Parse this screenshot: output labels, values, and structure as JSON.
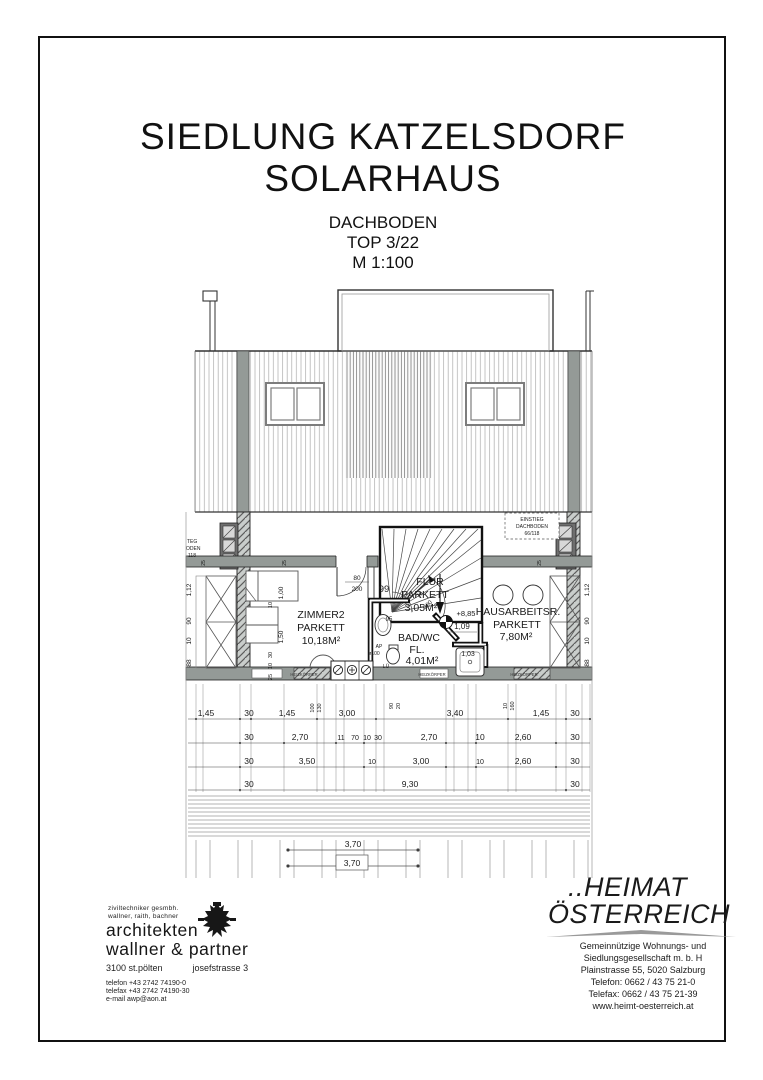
{
  "page": {
    "title1": "SIEDLUNG KATZELSDORF",
    "title2": "SOLARHAUS",
    "sub1": "DACHBODEN",
    "sub2": "TOP 3/22",
    "sub3": "M 1:100"
  },
  "plan": {
    "rooms": {
      "zimmer2": {
        "l1": "ZIMMER2",
        "l2": "PARKETT",
        "l3": "10,18M²"
      },
      "flur": {
        "l1": "FLUR",
        "l2": "PARKETT",
        "l3": "3,05M²"
      },
      "bad": {
        "l1": "BAD/WC",
        "l2": "FL.",
        "l3": "4,01M²"
      },
      "hausarbeit": {
        "l1": "HAUSARBEITSR.",
        "l2": "PARKETT",
        "l3": "7,80M²"
      }
    },
    "labels": {
      "left_l1": "TEG",
      "left_l2": "ODEN",
      "left_l3": "118",
      "right_l1": "EINSTIEG",
      "right_l2": "DACHBODEN",
      "right_l3": "66/118",
      "level": "+8,85",
      "heizkoerper": "HEIZKÖRPER",
      "ap": "AP",
      "d100": "ø100",
      "lue": "LÜ"
    },
    "dims": {
      "r1": [
        "1,45",
        "30",
        "1,45",
        "3,00",
        "3,40",
        "1,45",
        "30"
      ],
      "r1v": [
        "100",
        "130",
        "90",
        "20",
        "10",
        "160"
      ],
      "r2": [
        "30",
        "2,70",
        "11",
        "70",
        "10",
        "30",
        "2,70",
        "10",
        "2,60",
        "30"
      ],
      "r3": [
        "30",
        "3,50",
        "10",
        "3,00",
        "10",
        "2,60",
        "30"
      ],
      "r4": [
        "30",
        "9,30",
        "30"
      ],
      "bottom": [
        "3,70",
        "3,70"
      ],
      "leftcol": [
        "1,12",
        "90",
        "10",
        "88"
      ],
      "rightcol": [
        "1,12",
        "90",
        "10",
        "88"
      ],
      "inner": [
        "1,00",
        "10",
        "1,50",
        "30",
        "10",
        "25"
      ],
      "band": [
        "25",
        "25",
        "25"
      ],
      "door_z": [
        "80",
        "200"
      ],
      "door_b": [
        "70",
        "200"
      ],
      "stair_w": "99",
      "d95": "95",
      "d109": "1,09",
      "d103": "1,03"
    }
  },
  "footer": {
    "arch": {
      "tiny1": "ziviltechniker gesmbh.",
      "tiny2": "wallner, raith, bachner",
      "name1": "architekten",
      "name2": "wallner & partner",
      "city": "3100  st.pölten",
      "street": "josefstrasse 3",
      "tel": "telefon +43 2742 74190-0",
      "fax": "telefax +43 2742 74190-30",
      "mail": "e-mail awp@aon.at"
    },
    "heimat": {
      "logo1": "..HEIMAT",
      "logo2": "ÖSTERREICH",
      "a1": "Gemeinnützige Wohnungs- und",
      "a2": "Siedlungsgesellschaft m. b. H",
      "a3": "Plainstrasse 55, 5020 Salzburg",
      "a4": "Telefon: 0662 / 43 75 21-0",
      "a5": "Telefax: 0662 / 43 75 21-39",
      "a6": "www.heimt-oesterreich.at"
    }
  },
  "colors": {
    "wall_gray": "#949a97",
    "line_dark": "#1a1a1a",
    "hatch_gray": "#a8a8a8"
  }
}
